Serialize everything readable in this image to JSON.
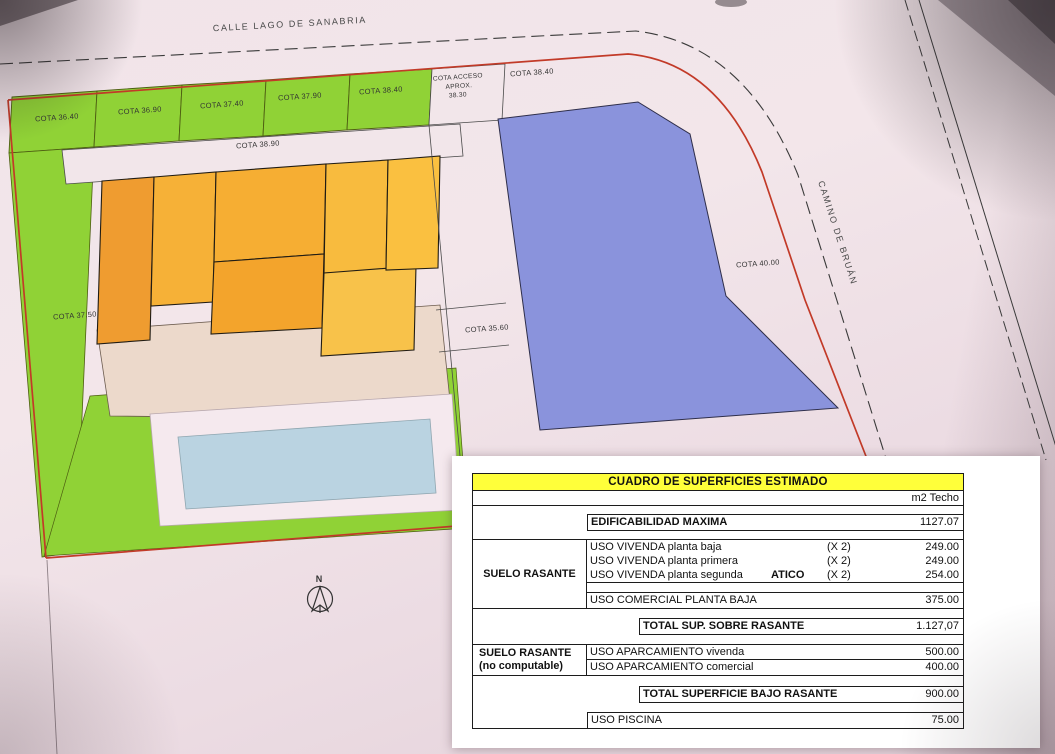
{
  "plan": {
    "street_top": "CALLE LAGO DE SANABRIA",
    "street_right": "CAMINO DE BRUÁN",
    "north_label": "N",
    "cotas": {
      "strip1": "COTA 36.40",
      "strip2": "COTA 36.90",
      "strip3": "COTA 37.40",
      "strip4": "COTA 37.90",
      "strip5": "COTA 38.40",
      "acceso_line1": "COTA ACCESO",
      "acceso_line2": "APROX.",
      "acceso_line3": "38.30",
      "right_cell": "COTA 38.40",
      "band": "COTA 38.90",
      "left_area": "COTA 37.50",
      "mid_strip": "COTA 35.60",
      "blue_parcel": "COTA 40.00"
    },
    "colors": {
      "plot_boundary_red": "#c23a28",
      "green_lawn": "#90d236",
      "building_orange": "#f5a733",
      "blue_parcel": "#8a93dc",
      "pool_blue": "#bad3e1",
      "table_header_yellow": "#ffff3a"
    }
  },
  "table": {
    "title": "CUADRO DE SUPERFICIES ESTIMADO",
    "unit_header": "m2 Techo",
    "edificabilidad": {
      "label": "EDIFICABILIDAD MAXIMA",
      "value": "1127.07"
    },
    "suelo_rasante": {
      "group_label": "SUELO RASANTE",
      "rows": [
        {
          "label": "USO VIVENDA planta baja",
          "atico": "",
          "mult": "(X 2)",
          "value": "249.00"
        },
        {
          "label": "USO VIVENDA planta primera",
          "atico": "",
          "mult": "(X 2)",
          "value": "249.00"
        },
        {
          "label": "USO VIVENDA planta segunda",
          "atico": "ATICO",
          "mult": "(X 2)",
          "value": "254.00"
        }
      ],
      "comercial": {
        "label": "USO COMERCIAL PLANTA BAJA",
        "value": "375.00"
      },
      "total": {
        "label": "TOTAL  SUP. SOBRE RASANTE",
        "value": "1.127,07"
      }
    },
    "bajo_rasante": {
      "group_label_line1": "SUELO RASANTE",
      "group_label_line2": "(no computable)",
      "rows": [
        {
          "label": "USO APARCAMIENTO vivenda",
          "value": "500.00"
        },
        {
          "label": "USO APARCAMIENTO comercial",
          "value": "400.00"
        }
      ],
      "total": {
        "label": "TOTAL SUPERFICIE  BAJO RASANTE",
        "value": "900.00"
      }
    },
    "piscina": {
      "label": "USO PISCINA",
      "value": "75.00"
    }
  }
}
